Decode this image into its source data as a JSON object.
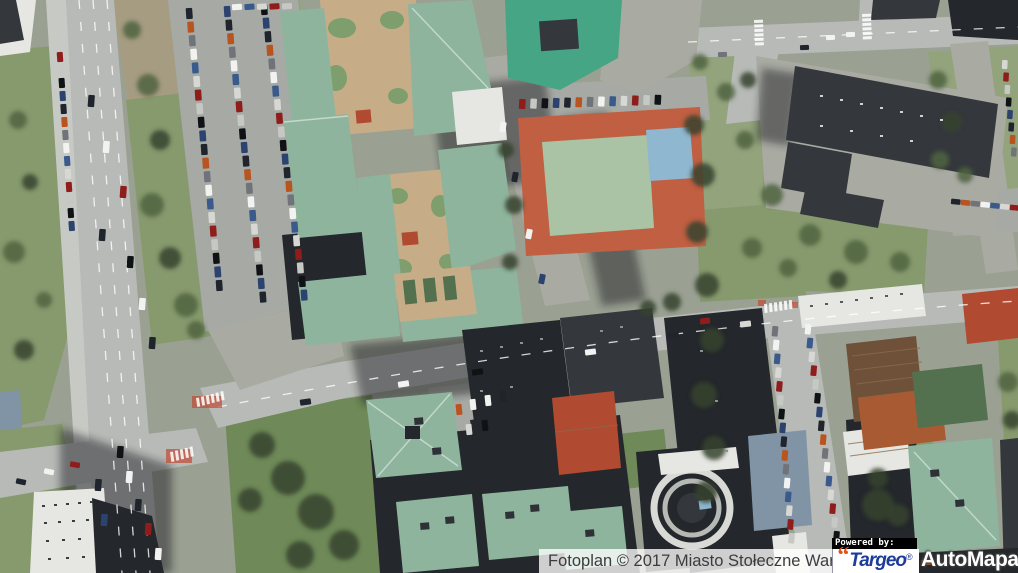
{
  "map": {
    "type": "aerial-photo",
    "location": "Warszawa",
    "colors": {
      "base": "#9aa092",
      "road": "#b7bab6",
      "road_minor": "#a9aba3",
      "sidewalk": "#c7c9c4",
      "parking": "#a7aaa4",
      "grass": "#879a6e",
      "grass_dark": "#6f8a58",
      "grass_light": "#93a37c",
      "bare_soil": "#a69c82",
      "tree": "#50633f",
      "tree_dark": "#36432d",
      "tree_light": "#6b8152",
      "roof_teal": "#8fb49e",
      "roof_teal_bright": "#46a585",
      "roof_teal_mid": "#6fa188",
      "roof_dark": "#34383c",
      "roof_black": "#24272b",
      "roof_red": "#b04a31",
      "roof_brown": "#6e5138",
      "roof_orange": "#a85a32",
      "roof_olive": "#53704f",
      "roof_slate_blue": "#8094a6",
      "wall_white": "#e6e7e3",
      "courtyard": "#c6ad87",
      "courtyard_green": "#7f9e6d",
      "track_red": "#c05f42",
      "field_green": "#a9c3a4",
      "court_blue": "#8fb7d0",
      "shadow": "#14171a",
      "marking": "#ffffff"
    },
    "car_colors": [
      "#20242c",
      "#f2f3f1",
      "#8f1d1c",
      "#2c436f",
      "#70747a",
      "#d7d8d4",
      "#101316",
      "#b8541f",
      "#3a5a8c",
      "#c6c8c4"
    ]
  },
  "attribution": {
    "text": "Fotoplan © 2017 Miasto Stołeczne Warszawa",
    "powered_by": "Powered by:",
    "targeo": {
      "mark": "“",
      "name": "Targeo",
      "registered": "®",
      "text_color": "#1d3d9b",
      "mark_color": "#e8501b"
    },
    "automapa": {
      "name": "AutoMapa",
      "registered": "®",
      "text_color": "#ffffff"
    }
  }
}
